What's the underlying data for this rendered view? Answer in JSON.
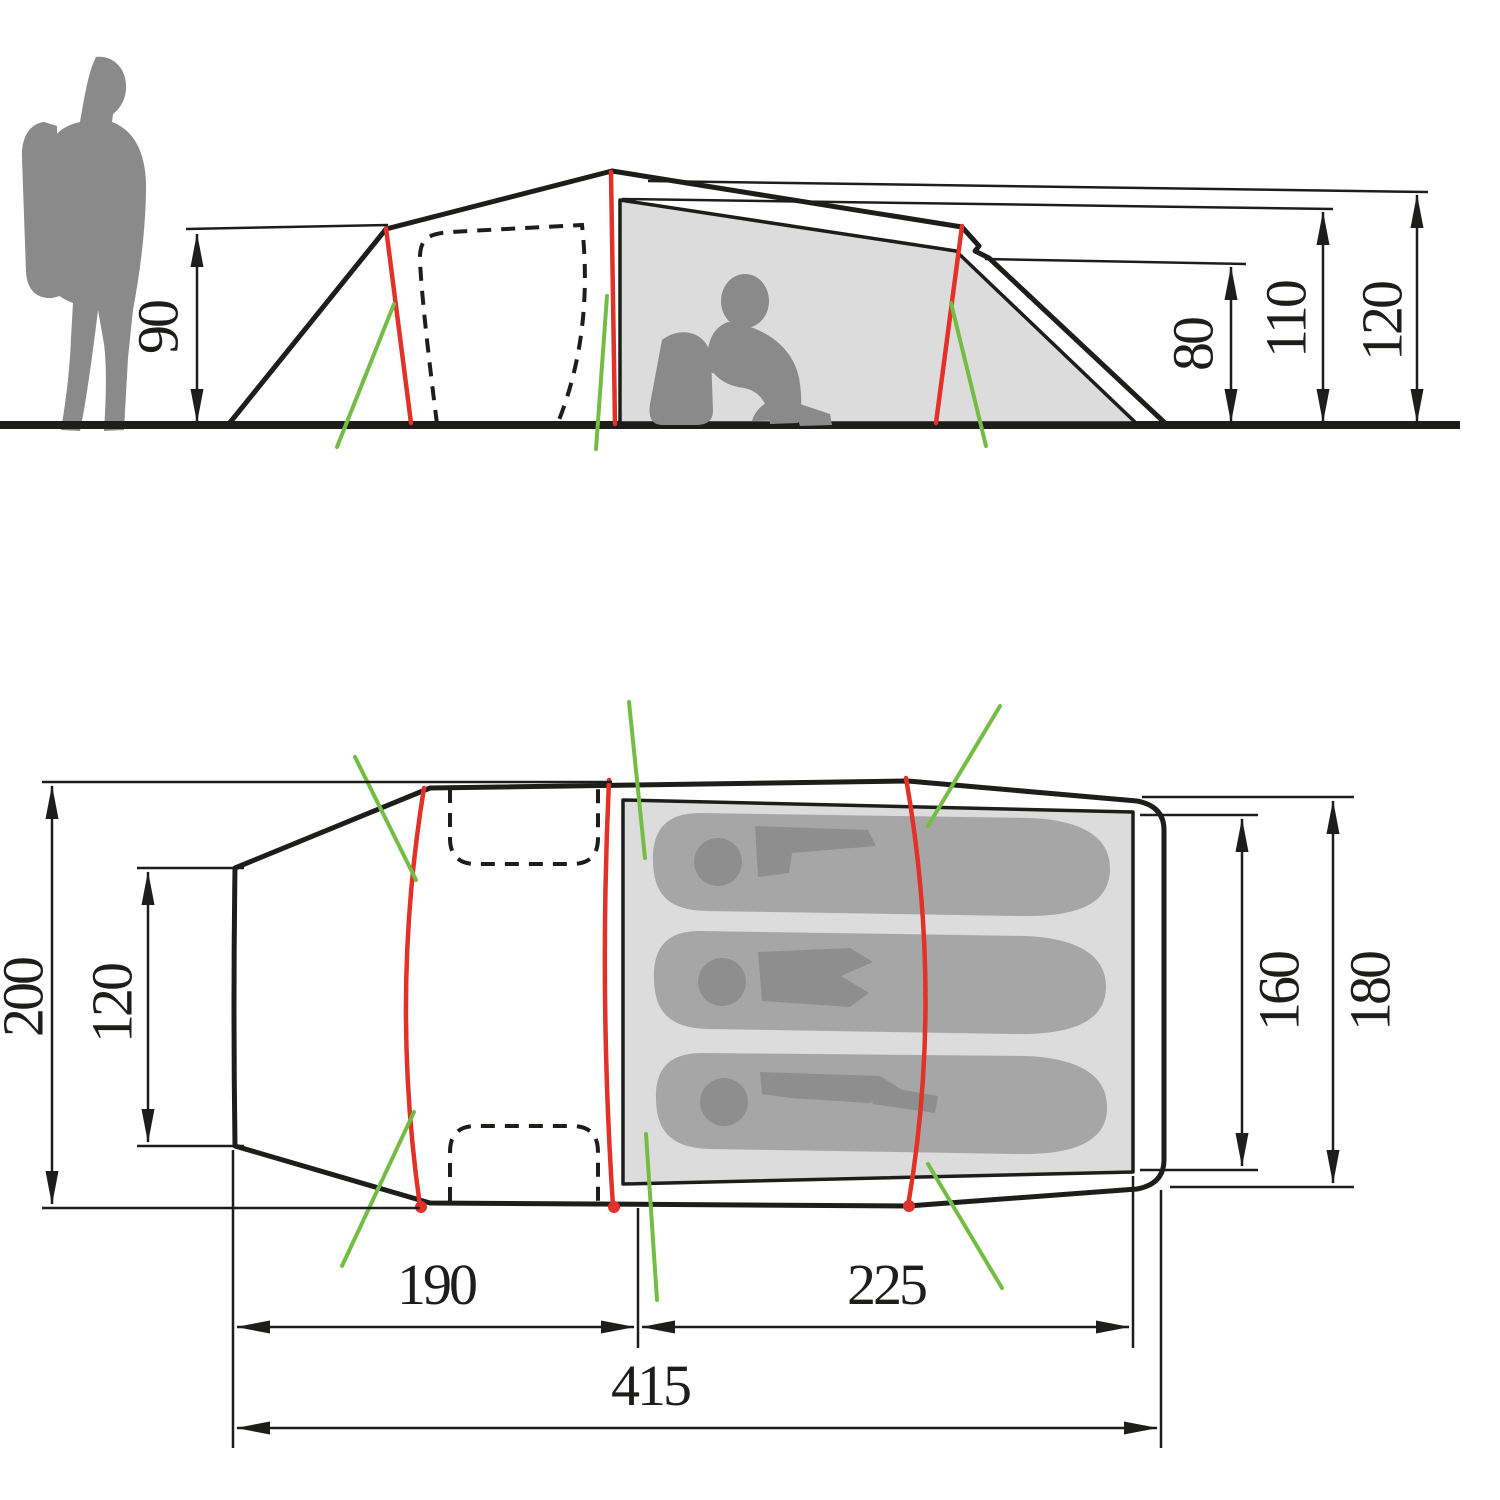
{
  "figure": {
    "kind": "tent-dimension-diagram",
    "views": [
      "side-elevation",
      "floor-plan"
    ]
  },
  "side_view": {
    "front_height": "90",
    "rear_inner_height": "80",
    "inner_peak_height": "110",
    "peak_height": "120"
  },
  "top_view": {
    "max_width": "200",
    "tail_end_width": "120",
    "inner_tent_width": "160",
    "rear_end_width": "180",
    "vestibule_length": "190",
    "inner_tent_length": "225",
    "total_length": "415"
  },
  "colors": {
    "line": "#1d1d1b",
    "pole_red": "#e23128",
    "guy_green": "#74bd44",
    "silhouette_gray": "#8a8a8a",
    "panel_gray": "#dcdcdc",
    "bag_gray": "#a6a6a6",
    "body_gray": "#8e8e8e",
    "background": "#ffffff"
  }
}
